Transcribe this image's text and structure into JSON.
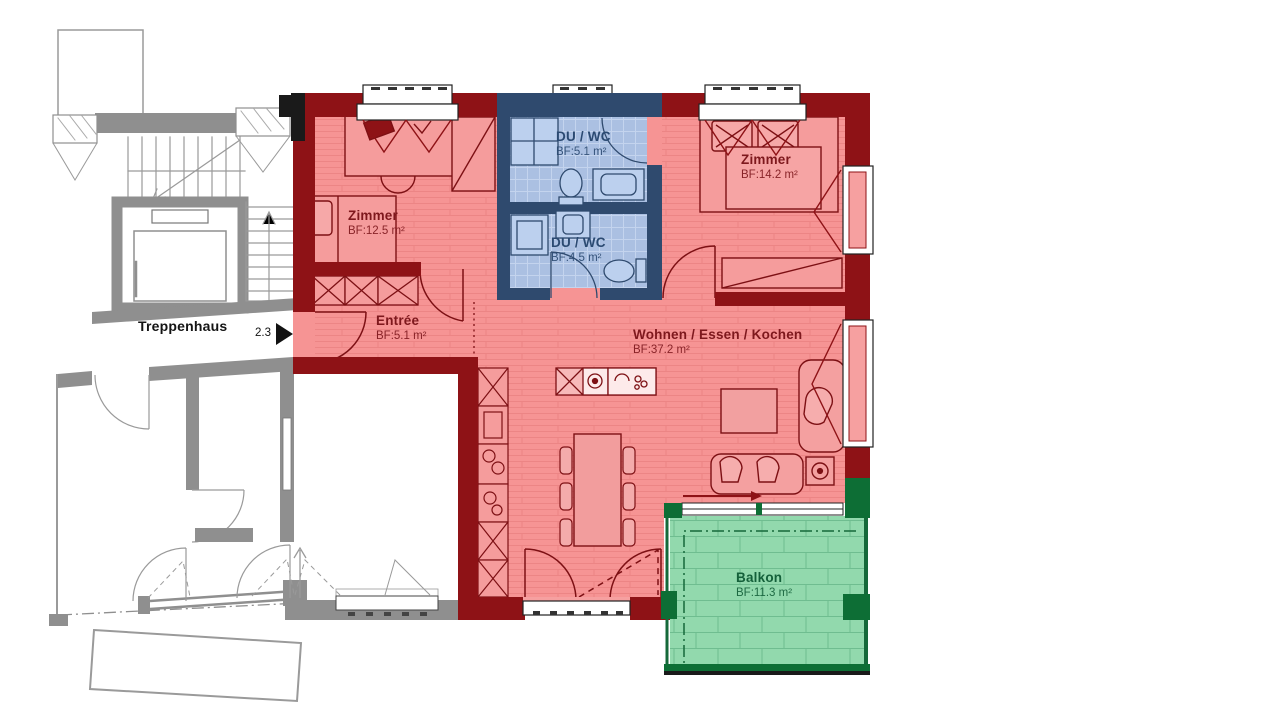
{
  "stairwell": {
    "label": "Treppenhaus",
    "unit_marker": "2.3"
  },
  "rooms": {
    "zimmer_left": {
      "name": "Zimmer",
      "area": "BF:12.5 m²"
    },
    "du_wc_top": {
      "name": "DU / WC",
      "area": "BF:5.1 m²"
    },
    "du_wc_bottom": {
      "name": "DU / WC",
      "area": "BF:4.5 m²"
    },
    "zimmer_right": {
      "name": "Zimmer",
      "area": "BF:14.2 m²"
    },
    "entree": {
      "name": "Entrée",
      "area": "BF:5.1 m²"
    },
    "wohnen": {
      "name": "Wohnen / Essen / Kochen",
      "area": "BF:37.2 m²"
    },
    "balkon": {
      "name": "Balkon",
      "area": "BF:11.3 m²"
    }
  },
  "colors": {
    "apartment_fill": "#f69494",
    "apartment_wall": "#8e1216",
    "wet_fill": "#abc0e2",
    "wet_wall": "#2f4a6e",
    "balcony_fill": "#92d9ad",
    "balcony_wall": "#0d6e35",
    "neighbor_gray": "#8f8f8f",
    "label_red": "#7e181d",
    "label_blue": "#2b4a72",
    "label_green": "#14603a"
  }
}
